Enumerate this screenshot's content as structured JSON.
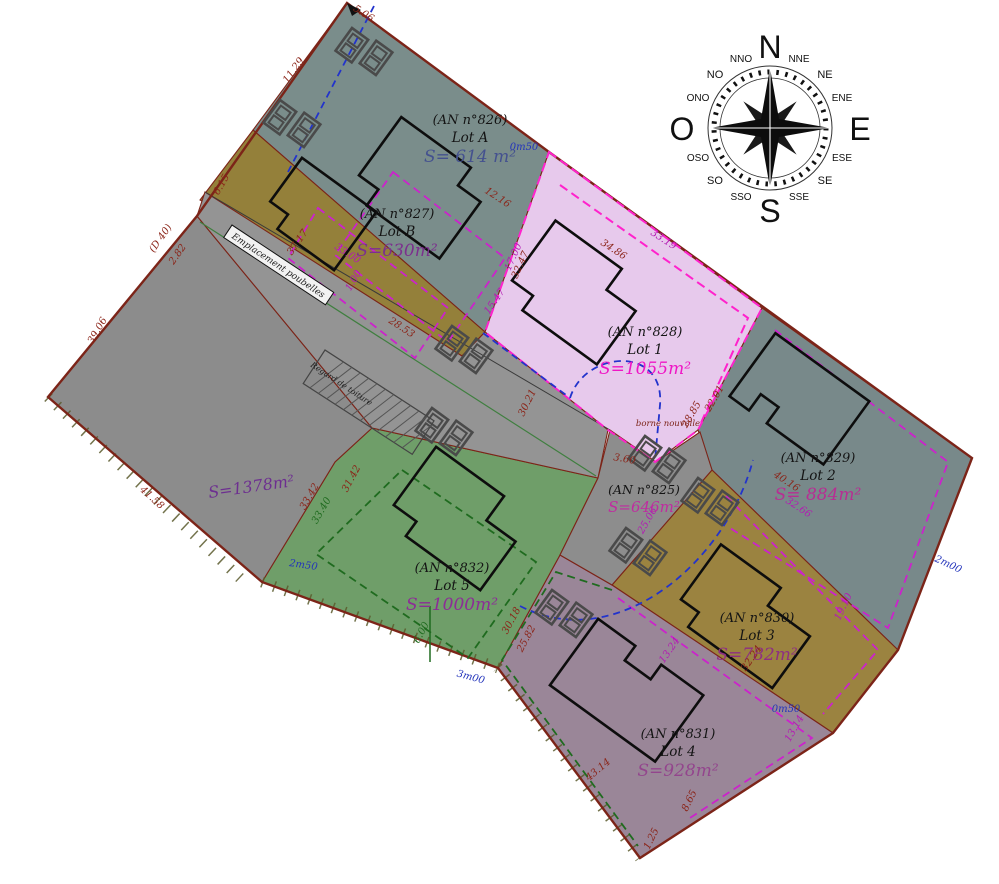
{
  "compass": {
    "n": "N",
    "e": "E",
    "s": "S",
    "o": "O",
    "nne": "NNE",
    "ne": "NE",
    "ene": "ENE",
    "ese": "ESE",
    "se": "SE",
    "sse": "SSE",
    "sso": "SSO",
    "so": "SO",
    "oso": "OSO",
    "ono": "ONO",
    "no": "NO",
    "nno": "NNO"
  },
  "lots": [
    {
      "id": "lot-a",
      "an": "(AN n°826)",
      "name": "Lot A",
      "area": "S= 614 m²",
      "fill": "#7a8d8b",
      "area_color": "#44518f"
    },
    {
      "id": "lot-b",
      "an": "(AN n°827)",
      "name": "Lot B",
      "area": "S=630m²",
      "fill": "#94803a",
      "area_color": "#7c2f8e"
    },
    {
      "id": "lot-1",
      "an": "(AN n°828)",
      "name": "Lot 1",
      "area": "S=1055m²",
      "fill": "#e7c9ec",
      "area_color": "#ef16c5"
    },
    {
      "id": "lot-2",
      "an": "(AN n°829)",
      "name": "Lot 2",
      "area": "S= 884m²",
      "fill": "#78898a",
      "area_color": "#b72e93"
    },
    {
      "id": "lot-3",
      "an": "(AN n°830)",
      "name": "Lot 3",
      "area": "S=782m²",
      "fill": "#9b8340",
      "area_color": "#8e2f82"
    },
    {
      "id": "lot-4",
      "an": "(AN n°831)",
      "name": "Lot 4",
      "area": "S=928m²",
      "fill": "#9a8698",
      "area_color": "#93458d"
    },
    {
      "id": "lot-5",
      "an": "(AN n°832)",
      "name": "Lot 5",
      "area": "S=1000m²",
      "fill": "#6f9e69",
      "area_color": "#8c2d96"
    }
  ],
  "common_area": {
    "an": "(AN n°825)",
    "area": "S=646m²",
    "fill": "#8d8d8d",
    "area_color": "#c02ba0"
  },
  "west_parcel": {
    "area": "S=1378m²",
    "fill": "#8c8c8c",
    "area_color": "#6d2f90"
  },
  "road": {
    "fill": "#949494"
  },
  "annotations": {
    "bins": "Emplacement poubelles",
    "new_marker": "borne nouvelle",
    "roof_drain": "Regard de toiture"
  },
  "dims": [
    {
      "t": "11.29"
    },
    {
      "t": "5.06"
    },
    {
      "t": "34.86"
    },
    {
      "t": "0m50"
    },
    {
      "t": "12.16"
    },
    {
      "t": "17.00"
    },
    {
      "t": "33.19"
    },
    {
      "t": "37.17"
    },
    {
      "t": "33.00"
    },
    {
      "t": "1.00"
    },
    {
      "t": "15.47"
    },
    {
      "t": "32.47"
    },
    {
      "t": "28.85"
    },
    {
      "t": "22.01"
    },
    {
      "t": "2m00"
    },
    {
      "t": "40.16"
    },
    {
      "t": "32.66"
    },
    {
      "t": "19.10"
    },
    {
      "t": "32.24"
    },
    {
      "t": "13.24"
    },
    {
      "t": "13.14"
    },
    {
      "t": "0m50"
    },
    {
      "t": "8.65"
    },
    {
      "t": "1.25"
    },
    {
      "t": "43.14"
    },
    {
      "t": "3m00"
    },
    {
      "t": "30.18"
    },
    {
      "t": "25.82"
    },
    {
      "t": "6.00"
    },
    {
      "t": "2m50"
    },
    {
      "t": "33.42"
    },
    {
      "t": "33.40"
    },
    {
      "t": "41.58"
    },
    {
      "t": "39.06"
    },
    {
      "t": "2.82"
    },
    {
      "t": "(D 40)"
    },
    {
      "t": "6.15"
    },
    {
      "t": "28.53"
    },
    {
      "t": "25.06"
    },
    {
      "t": "3.60"
    },
    {
      "t": "31.42"
    },
    {
      "t": "30.21"
    }
  ]
}
